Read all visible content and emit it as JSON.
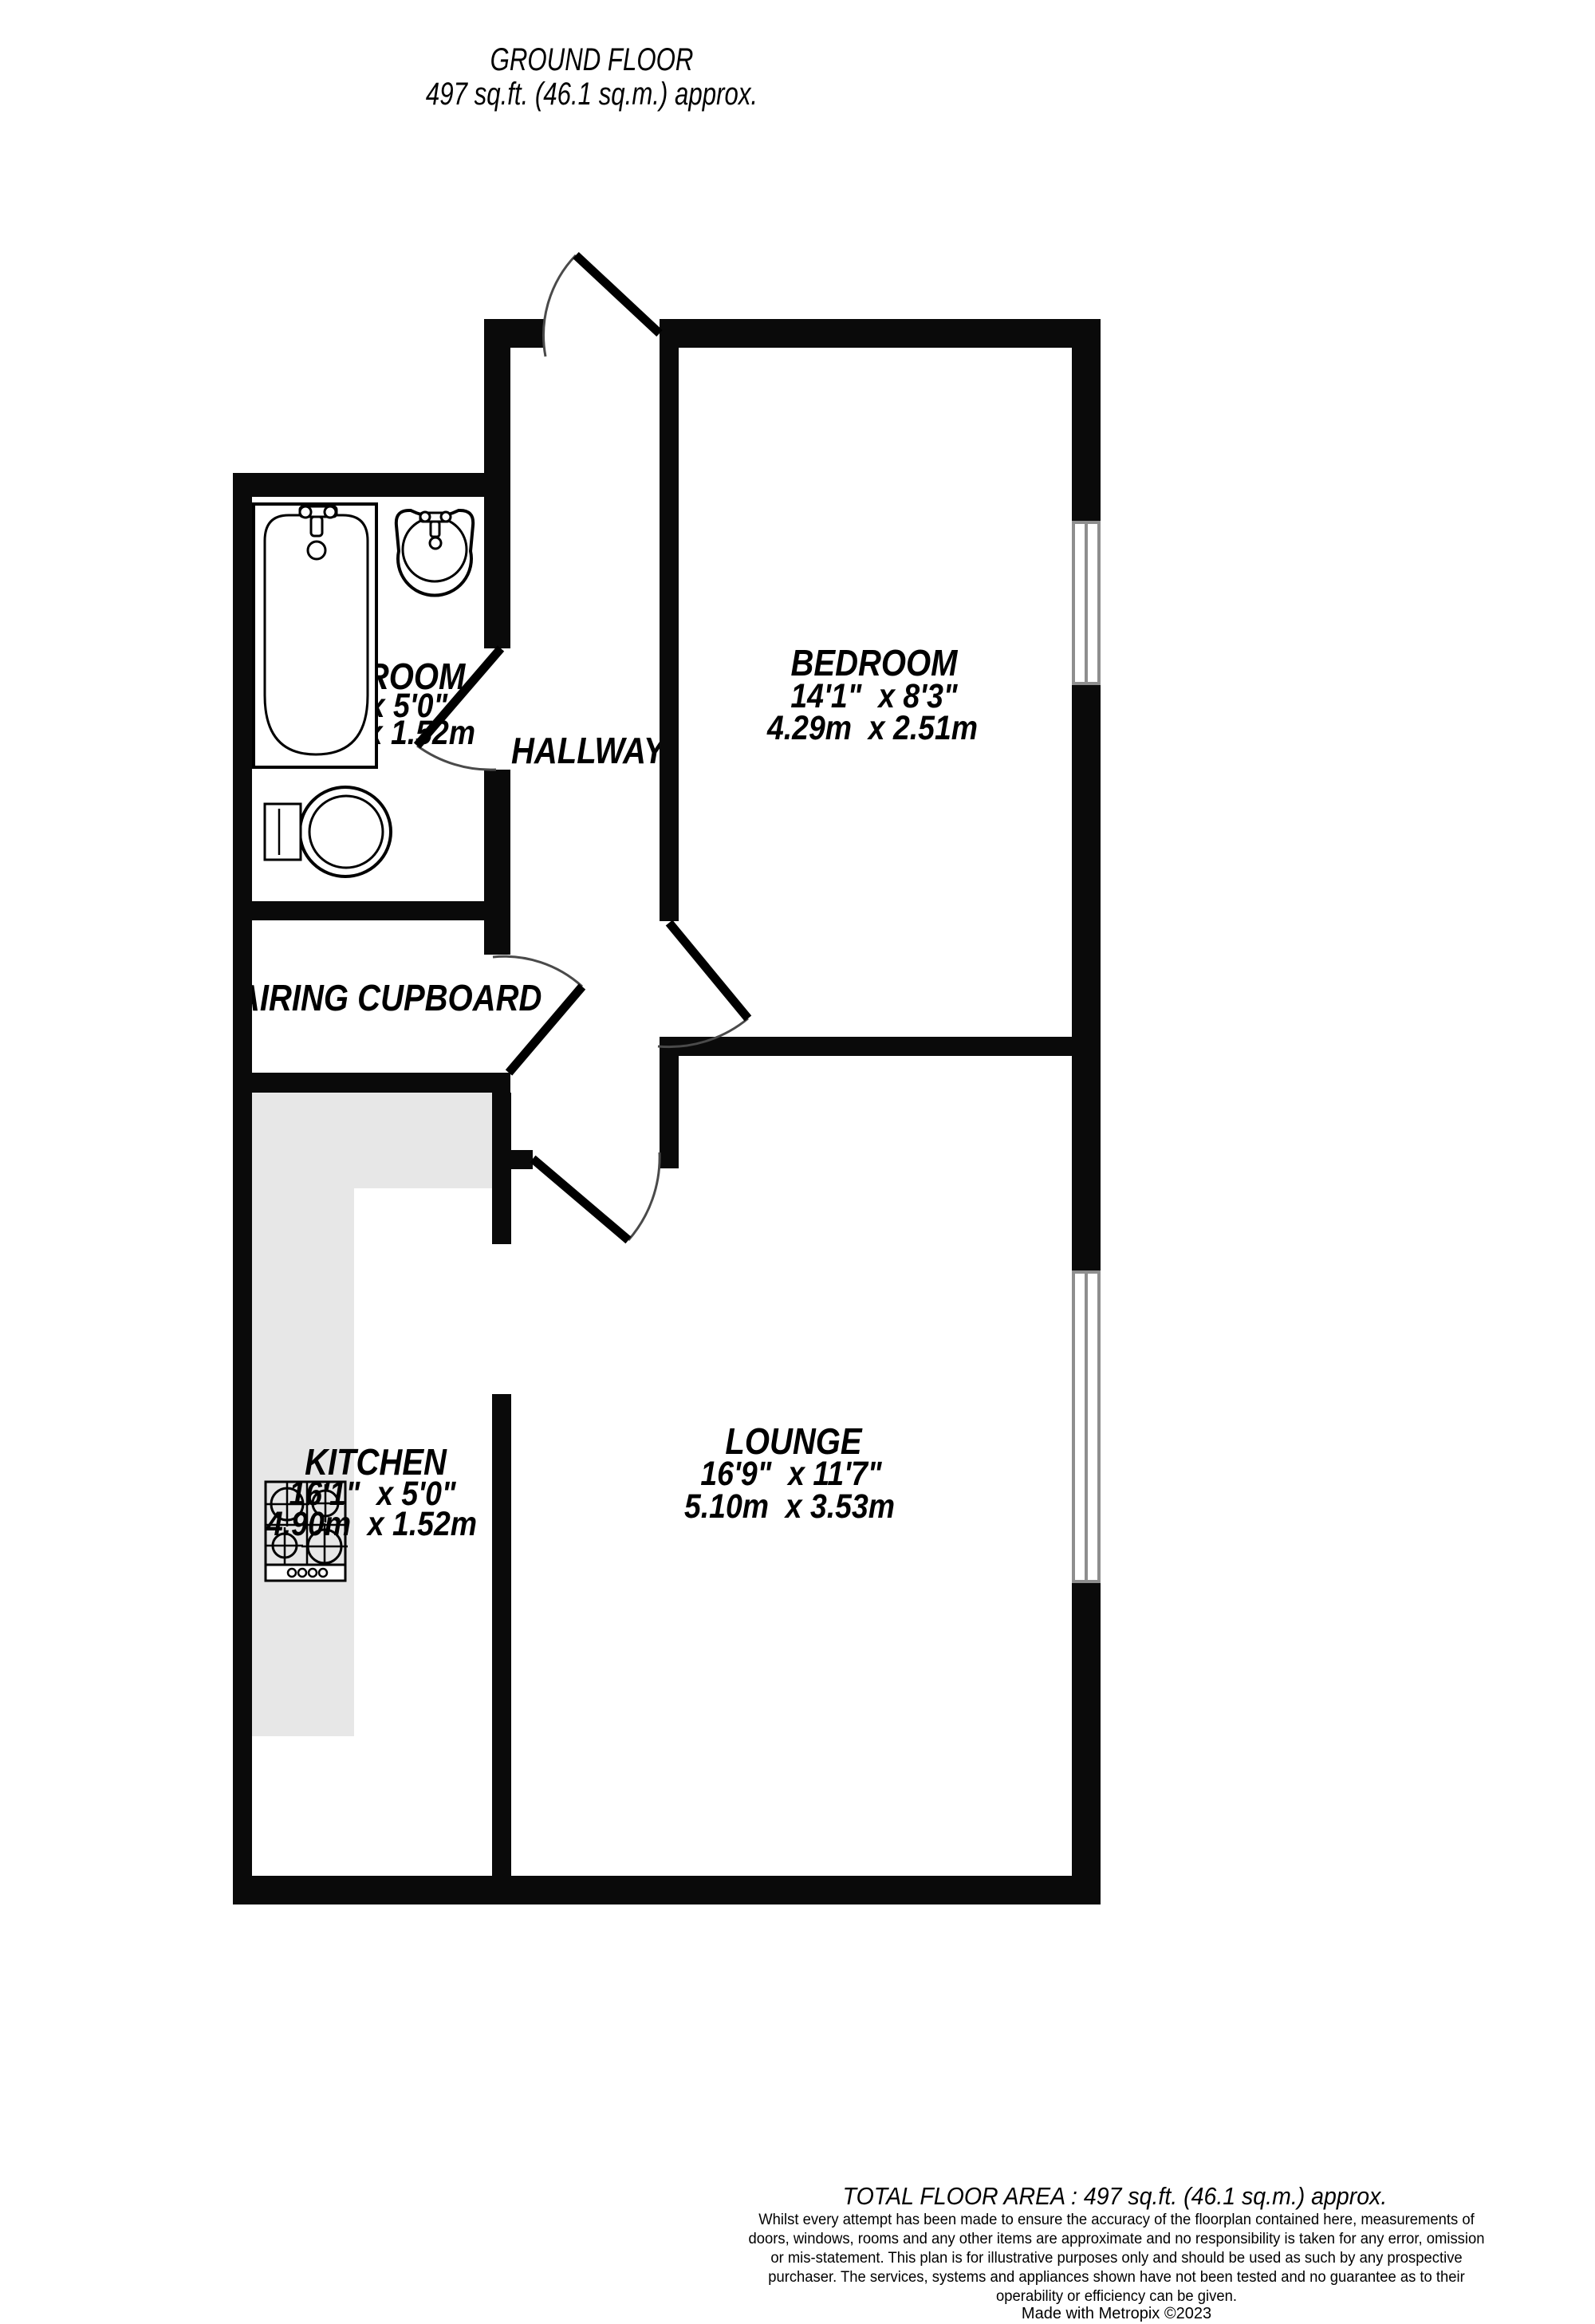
{
  "header": {
    "floor_label": "GROUND FLOOR",
    "area_label": "497 sq.ft. (46.1 sq.m.) approx."
  },
  "rooms": {
    "bathroom": {
      "name": "BATHROOM",
      "imperial": "8'5\"  x 5'0\"",
      "metric": "2.56m  x 1.52m"
    },
    "hallway": {
      "name": "HALLWAY"
    },
    "bedroom": {
      "name": "BEDROOM",
      "imperial": "14'1\"  x 8'3\"",
      "metric": "4.29m  x 2.51m"
    },
    "airing_cupboard": {
      "name": "AIRING CUPBOARD"
    },
    "kitchen": {
      "name": "KITCHEN",
      "imperial": "16'1\"  x 5'0\"",
      "metric": "4.90m  x 1.52m"
    },
    "lounge": {
      "name": "LOUNGE",
      "imperial": "16'9\"  x 11'7\"",
      "metric": "5.10m  x 3.53m"
    }
  },
  "footer": {
    "total_area": "TOTAL FLOOR AREA : 497 sq.ft. (46.1 sq.m.) approx.",
    "disclaimer": "Whilst every attempt has been made to ensure the accuracy of the floorplan contained here, measurements of doors, windows, rooms and any other items are approximate and no responsibility is taken for any error, omission or mis-statement. This plan is for illustrative purposes only and should be used as such by any prospective purchaser. The services, systems and appliances shown have not been tested and no guarantee as to their operability or efficiency can be given.",
    "credit": "Made with Metropix ©2023"
  },
  "colors": {
    "wall": "#0a0a0a",
    "counter": "#e7e7e7",
    "window_line": "#8e8e8e",
    "door_arc": "#4a4a4a"
  }
}
